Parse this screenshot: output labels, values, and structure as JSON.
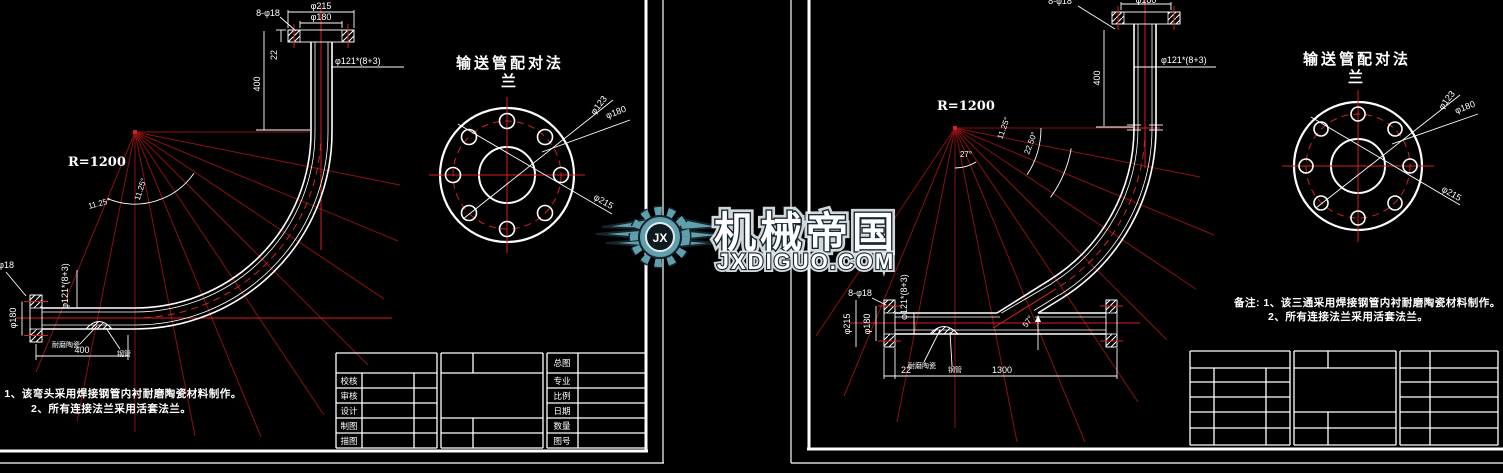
{
  "logo": {
    "brand": "机械帝国",
    "domain": "JXDIGUO.COM",
    "monogram": "JX",
    "teal": "#5f9fae"
  },
  "colors": {
    "background": "#000000",
    "line": "#ffffff",
    "centerline": "#d42020",
    "construction": "#8a1212"
  },
  "left": {
    "radius": "R=1200",
    "top": {
      "od": "φ215",
      "bcd": "φ180",
      "bolts": "8-φ18",
      "thk": "22",
      "len": "400",
      "pipe": "φ121*(8+3)"
    },
    "angles": {
      "a1": "11.25°",
      "a2": "11.25°"
    },
    "bottom": {
      "bolts": "8-φ18",
      "bcd": "φ180",
      "pipe": "φ121*(8+3)",
      "len": "400",
      "lining": "耐磨陶瓷",
      "steel": "钢管"
    },
    "flange": {
      "t1": "输送管配对法",
      "t2": "兰",
      "d1": "φ123",
      "d2": "φ180",
      "d3": "φ215"
    },
    "notes": {
      "l1": "注: 1、该弯头采用焊接钢管内衬耐磨陶瓷材料制作。",
      "l2": "2、所有连接法兰采用活套法兰。"
    },
    "tb": {
      "general": "总图",
      "col_left": [
        "校核",
        "审核",
        "设计",
        "制图",
        "描图"
      ],
      "col_right": [
        "专业",
        "比例",
        "日期",
        "数量",
        "图号"
      ]
    }
  },
  "right": {
    "radius": "R=1200",
    "top": {
      "bolts": "8-φ18",
      "od": "φ180",
      "len": "400",
      "pipe": "φ121*(8+3)"
    },
    "angles": {
      "fan": "27°",
      "a1": "11.25°",
      "a2": "22.50°",
      "branch": "57°"
    },
    "bottom": {
      "bolts": "8-φ18",
      "od": "φ215",
      "bcd": "φ180",
      "pipe": "φ121*(8+3)",
      "thk": "22",
      "len": "1300",
      "lining": "耐磨陶瓷",
      "steel": "钢管"
    },
    "flange": {
      "t1": "输送管配对法",
      "t2": "兰",
      "d1": "φ123",
      "d2": "φ180",
      "d3": "φ215"
    },
    "notes": {
      "l1": "备注: 1、该三通采用焊接钢管内衬耐磨陶瓷材料制作。",
      "l2": "2、所有连接法兰采用活套法兰。"
    }
  }
}
